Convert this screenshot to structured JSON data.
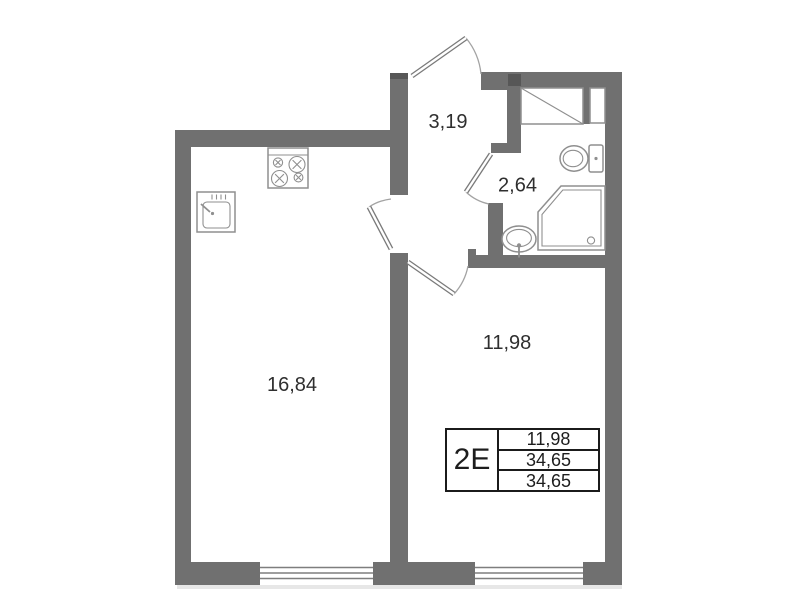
{
  "plan": {
    "title": "apartment-floor-plan",
    "rooms": [
      {
        "name": "kitchen-living-room",
        "area": "16,84"
      },
      {
        "name": "bedroom",
        "area": "11,98"
      },
      {
        "name": "hallway",
        "area": "3,19"
      },
      {
        "name": "bathroom",
        "area": "2,64"
      }
    ],
    "legend": {
      "code": "2Е",
      "values": [
        "11,98",
        "34,65",
        "34,65"
      ]
    },
    "fixtures": [
      "stove-icon",
      "kitchen-sink-icon",
      "toilet-icon",
      "shower-icon",
      "bathroom-sink-icon",
      "wardrobe-shaft-icon",
      "vent-shaft-icon"
    ],
    "colors": {
      "wall": "#707070",
      "fixture": "#8f8f8f",
      "text": "#2f2f2f",
      "legend_border": "#1b1b1b"
    }
  }
}
